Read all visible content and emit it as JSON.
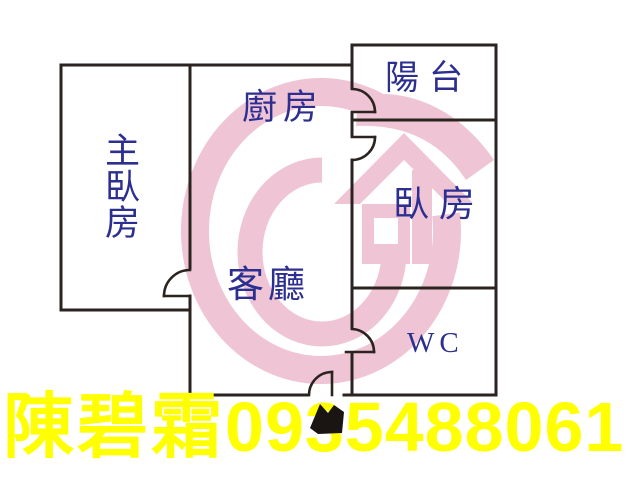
{
  "title": "apartment-floor-plan",
  "floorplan": {
    "rooms": [
      {
        "id": "master-bedroom",
        "label": "主臥房"
      },
      {
        "id": "kitchen",
        "label": "廚房"
      },
      {
        "id": "balcony",
        "label": "陽台"
      },
      {
        "id": "bedroom",
        "label": "臥房"
      },
      {
        "id": "living-room",
        "label": "客廳"
      },
      {
        "id": "wc",
        "label": "WC"
      }
    ],
    "door_count": 5
  },
  "watermark": {
    "description": "pink realtor logo: G-shaped double ring with house and swoosh",
    "color": "#efc5d6"
  },
  "agent_banner": {
    "name": "陳碧霜",
    "phone": "0935488061",
    "text_color": "#ffff00"
  },
  "colors": {
    "background": "#ffffff",
    "wall": "#2a2320",
    "room_label": "#2c2e90",
    "banner_text": "#ffff00",
    "watermark_pink": "#efc5d6"
  }
}
